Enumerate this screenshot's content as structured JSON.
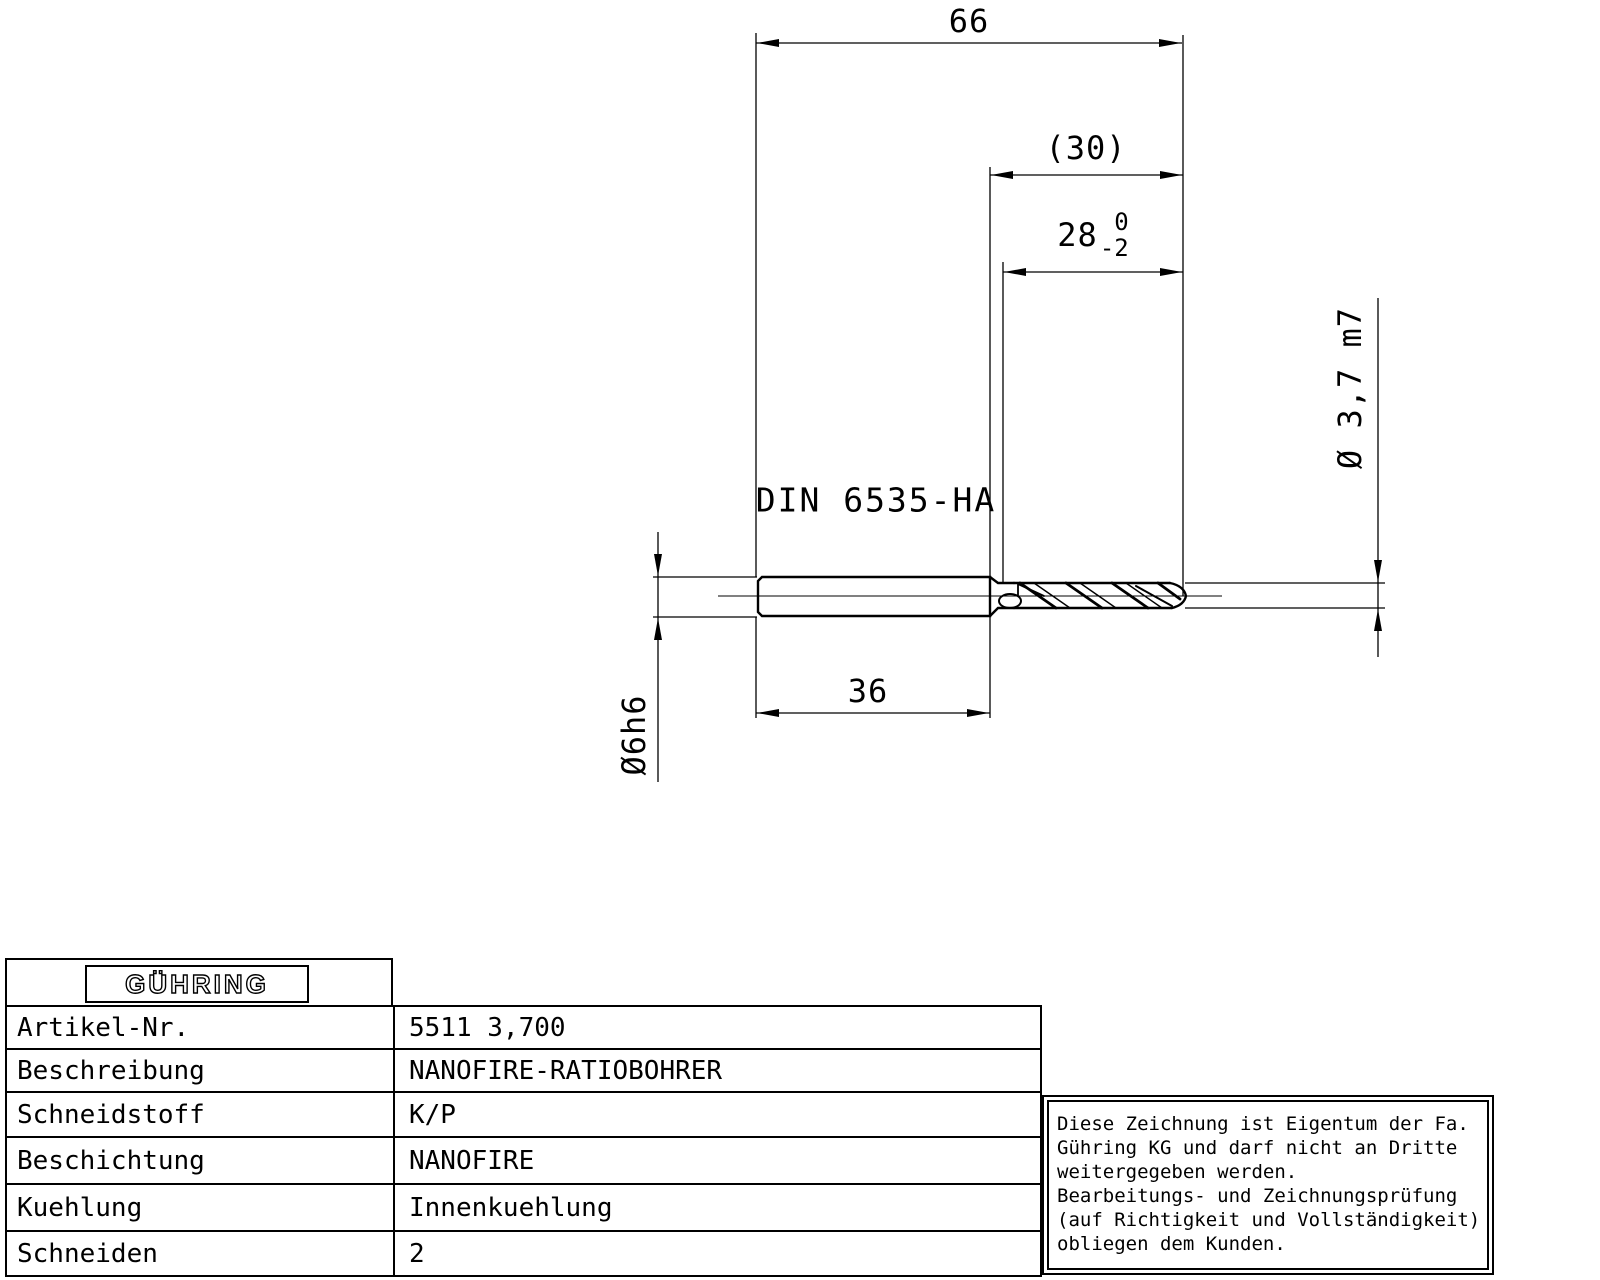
{
  "drawing": {
    "dim_overall_length": "66",
    "dim_flute_length_ref": "(30)",
    "dim_usable_length_nominal": "28",
    "dim_usable_length_tol_upper": "0",
    "dim_usable_length_tol_lower": "-2",
    "dim_shank_length": "36",
    "dim_shank_diameter": "Ø6h6",
    "dim_drill_diameter": "Ø 3,7 m7",
    "shank_standard": "DIN 6535-HA"
  },
  "titleblock": {
    "logo": "GÜHRING",
    "rows": [
      {
        "label": "Artikel-Nr.",
        "value": "5511 3,700"
      },
      {
        "label": "Beschreibung",
        "value": "NANOFIRE-RATIOBOHRER"
      },
      {
        "label": "Schneidstoff",
        "value": "K/P"
      },
      {
        "label": "Beschichtung",
        "value": "NANOFIRE"
      },
      {
        "label": "Kuehlung",
        "value": "Innenkuehlung"
      },
      {
        "label": "Schneiden",
        "value": "2"
      }
    ]
  },
  "notice": {
    "lines": [
      "Diese Zeichnung ist Eigentum der Fa.",
      "Gühring KG und darf nicht an Dritte",
      "weitergegeben werden.",
      "Bearbeitungs- und Zeichnungsprüfung",
      "(auf Richtigkeit und Vollständigkeit)",
      "obliegen dem Kunden."
    ]
  },
  "colors": {
    "line": "#000000",
    "background": "#ffffff"
  }
}
